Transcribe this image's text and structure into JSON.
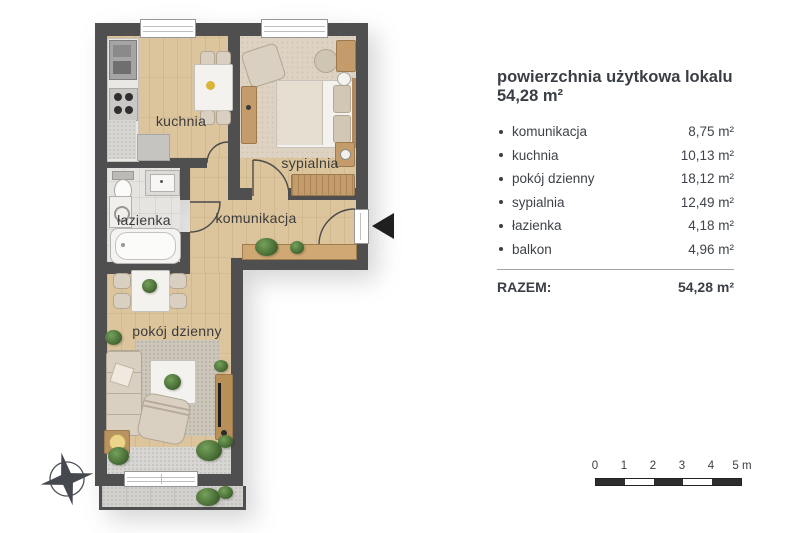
{
  "plan": {
    "rooms": {
      "kuchnia": "kuchnia",
      "sypialnia": "sypialnia",
      "lazienka": "łazienka",
      "komunikacja": "komunikacja",
      "pokoj_dzienny": "pokój dzienny"
    }
  },
  "legend": {
    "title_line1": "powierzchnia użytkowa lokalu",
    "title_line2": "54,28 m²",
    "items": [
      {
        "label": "komunikacja",
        "value": "8,75 m²"
      },
      {
        "label": "kuchnia",
        "value": "10,13 m²"
      },
      {
        "label": "pokój dzienny",
        "value": "18,12 m²"
      },
      {
        "label": "sypialnia",
        "value": "12,49 m²"
      },
      {
        "label": "łazienka",
        "value": "4,18 m²"
      },
      {
        "label": "balkon",
        "value": "4,96 m²"
      }
    ],
    "total_label": "RAZEM:",
    "total_value": "54,28 m²"
  },
  "scale_bar": {
    "labels": [
      "0",
      "1",
      "2",
      "3",
      "4",
      "5 m"
    ]
  },
  "colors": {
    "wall": "#4f4f4f",
    "wood_floor": "#dcc59d",
    "carpet": "#ded3c3",
    "tile": "#e6e4e0",
    "text": "#3a3f45",
    "arrow": "#1f1f1f"
  }
}
